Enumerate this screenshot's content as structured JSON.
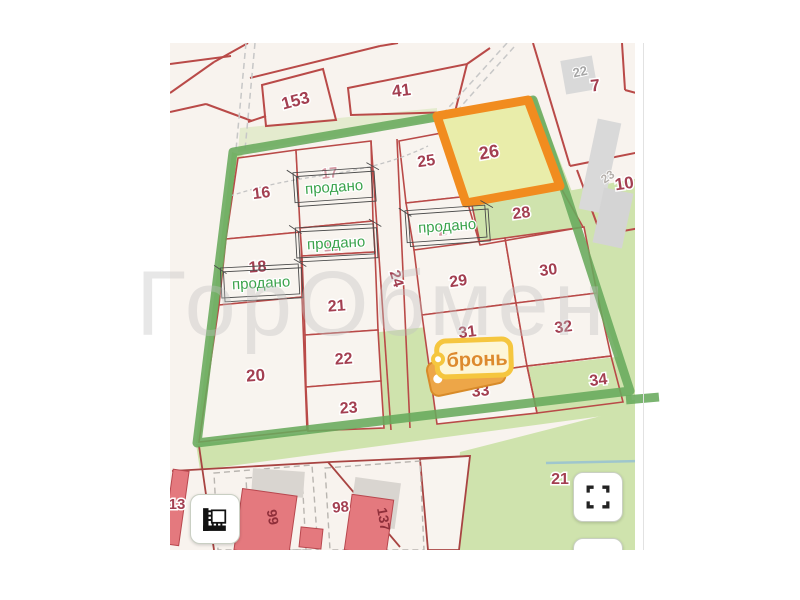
{
  "page": {
    "watermark": "ГорОбмен"
  },
  "map": {
    "sold_label": "продано",
    "reserved_label": "бронь",
    "colors": {
      "boundary_green": "#68aa5c",
      "highlight_orange": "#f18c1f",
      "highlight_fill": "#e9edaa",
      "parcel_line_red": "#b94a48",
      "label_red": "#a33f51",
      "sold_green": "#3aa34c",
      "reserved_orange": "#dd8a2e",
      "field_green": "#cfe3ad"
    },
    "parcels": {
      "p153": "153",
      "p41": "41",
      "b22": "22",
      "p7": "7",
      "b23": "23",
      "p10": "10",
      "p16": "16",
      "p17": "17",
      "p18": "18",
      "p19": "19",
      "p20": "20",
      "p21": "21",
      "p22": "22",
      "p23": "23",
      "p24": "24",
      "p25": "25",
      "p26": "26",
      "p27": "27",
      "p28": "28",
      "p29": "29",
      "p30": "30",
      "p31": "31",
      "p32": "32",
      "p33": "33",
      "p34": "34",
      "p13": "13",
      "b99": "99",
      "p98": "98",
      "b137": "137",
      "p21b": "21"
    }
  }
}
